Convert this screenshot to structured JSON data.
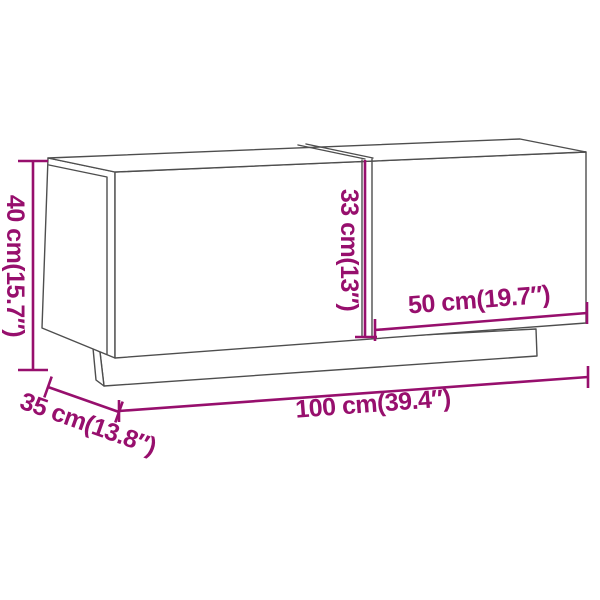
{
  "diagram": {
    "type": "product-dimension-drawing",
    "subject": "tv-cabinet-with-two-doors-line-drawing"
  },
  "dimensions": {
    "height": {
      "cm": 40,
      "inches": 15.7,
      "label": "40 cm(15.7″)"
    },
    "inner_height": {
      "cm": 33,
      "inches": 13,
      "label": "33 cm(13″)"
    },
    "section_width": {
      "cm": 50,
      "inches": 19.7,
      "label": "50 cm(19.7″)"
    },
    "width": {
      "cm": 100,
      "inches": 39.4,
      "label": "100 cm(39.4″)"
    },
    "depth": {
      "cm": 35,
      "inches": 13.8,
      "label": "35 cm(13.8″)"
    }
  },
  "colors": {
    "dimension": "#970f6d",
    "outline": "#4e4e4e",
    "background": "#ffffff"
  }
}
